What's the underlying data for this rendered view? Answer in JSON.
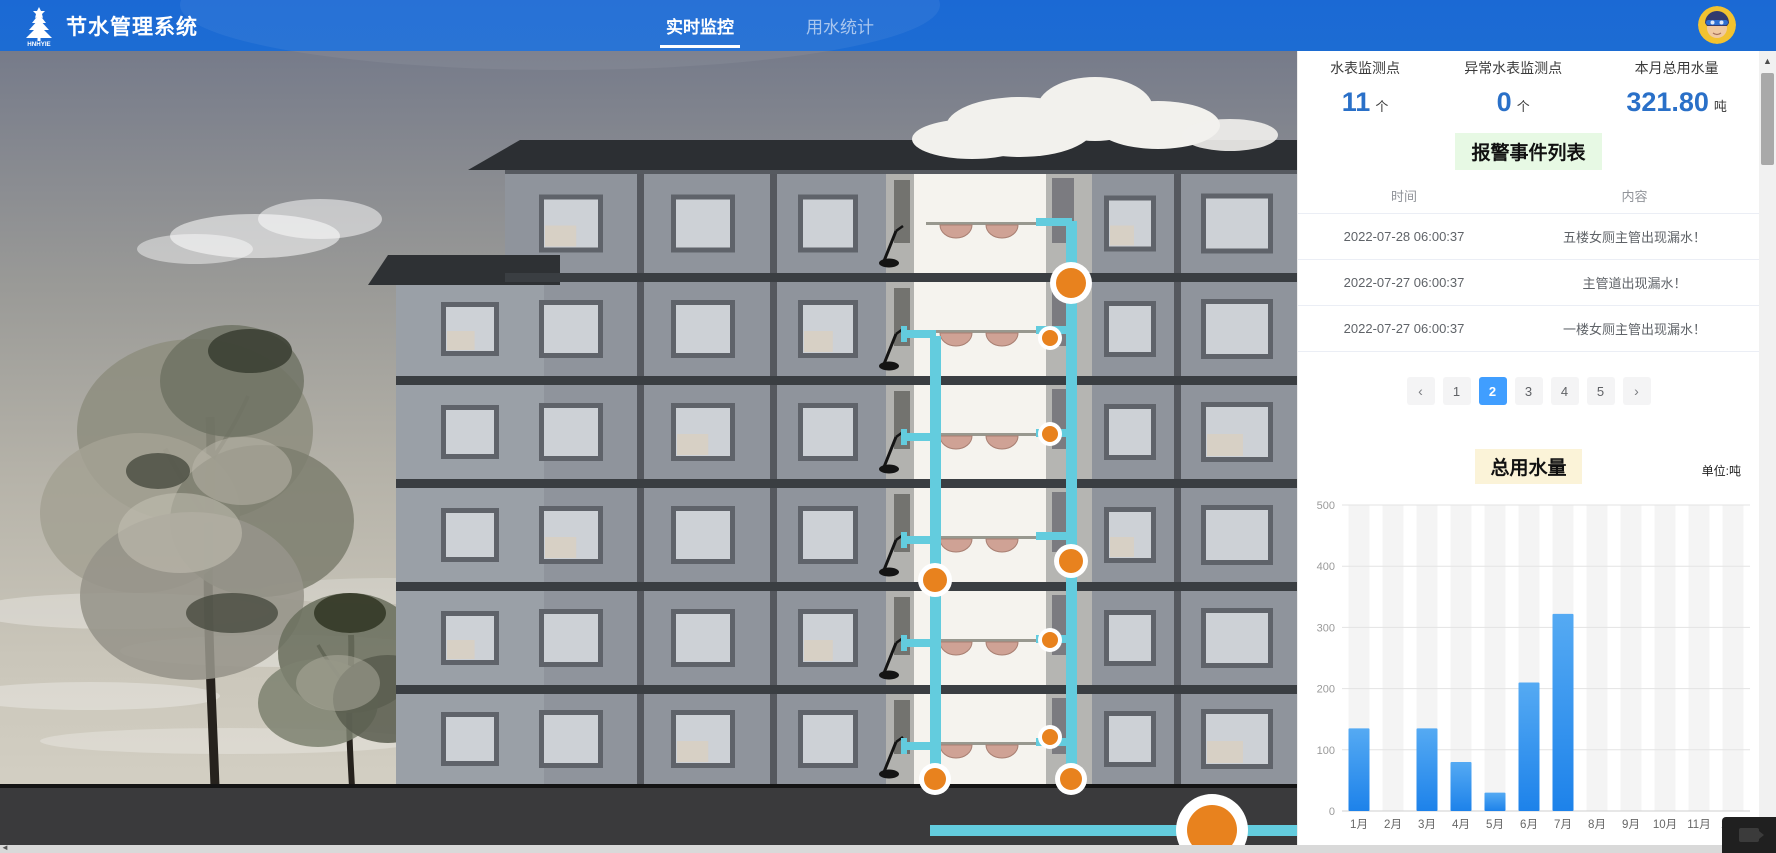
{
  "header": {
    "title": "节水管理系统",
    "logo_text": "HNHYIE",
    "tabs": [
      {
        "label": "实时监控",
        "active": true
      },
      {
        "label": "用水统计",
        "active": false
      }
    ]
  },
  "stats": [
    {
      "label": "水表监测点",
      "value": "11",
      "unit": "个"
    },
    {
      "label": "异常水表监测点",
      "value": "0",
      "unit": "个"
    },
    {
      "label": "本月总用水量",
      "value": "321.80",
      "unit": "吨"
    }
  ],
  "alarm": {
    "title": "报警事件列表",
    "columns": [
      "时间",
      "内容"
    ],
    "rows": [
      {
        "time": "2022-07-28 06:00:37",
        "content": "五楼女厕主管出现漏水！"
      },
      {
        "time": "2022-07-27 06:00:37",
        "content": "主管道出现漏水！"
      },
      {
        "time": "2022-07-27 06:00:37",
        "content": "一楼女厕主管出现漏水！"
      }
    ]
  },
  "pagination": {
    "prev_label": "‹",
    "next_label": "›",
    "pages": [
      "1",
      "2",
      "3",
      "4",
      "5"
    ],
    "active": "2"
  },
  "chart_data": {
    "type": "bar",
    "title": "总用水量",
    "unit_label": "单位:吨",
    "categories": [
      "1月",
      "2月",
      "3月",
      "4月",
      "5月",
      "6月",
      "7月",
      "8月",
      "9月",
      "10月",
      "11月",
      "12月"
    ],
    "values": [
      135,
      0,
      135,
      80,
      30,
      210,
      322,
      0,
      0,
      0,
      0,
      0
    ],
    "ylim": [
      0,
      500
    ],
    "yticks": [
      0,
      100,
      200,
      300,
      400,
      500
    ],
    "grid": true,
    "legend": null,
    "bar_color": "#2f93ef"
  },
  "colors": {
    "header_blue": "#1c6cd3",
    "stat_value_blue": "#2a70c8",
    "pagination_active": "#409eff",
    "alarm_title_bg": "#e7f9e4",
    "chart_title_bg": "#fbf3d8",
    "bar_blue": "#2f93ef",
    "pipe_cyan": "#63ccde",
    "meter_orange": "#e8821e"
  }
}
